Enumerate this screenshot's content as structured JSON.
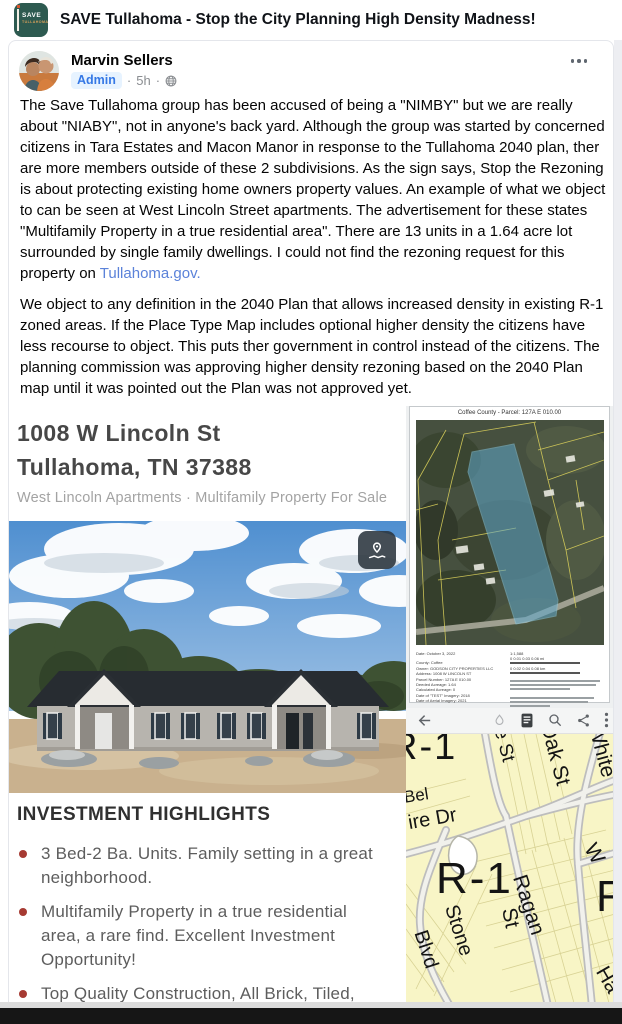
{
  "group_header": {
    "title": "SAVE Tullahoma - Stop the City Planning High Density Madness!",
    "logo_line1": "SAVE",
    "logo_line2": "TULLAHOMA"
  },
  "post": {
    "author": "Marvin Sellers",
    "badge": "Admin",
    "dot1": "·",
    "timestamp": "5h",
    "dot2": "·",
    "body": [
      {
        "text": "The Save Tullahoma group has been accused of being a \"NIMBY\" but we are really about \"NIABY\", not in anyone's back yard. Although the group was started by concerned citizens in Tara Estates and Macon Manor in response to the Tullahoma 2040 plan, ther are more members outside of these 2 subdivisions. As the sign says, Stop the Rezoning is about protecting existing home owners property values. An example of what we object to can be seen at West Lincoln Street apartments. The advertisement for these states \"Multifamily Property in a true residential area\". There are 13 units in a 1.64 acre lot surrounded by single family dwellings. I could not find the rezoning request for this property on ",
        "link": "Tullahoma.gov."
      },
      {
        "text": "We object to any definition in the 2040 Plan that allows increased density in existing R-1 zoned areas. If the Place Type Map includes optional higher density the citizens have less recourse to object. This puts ther government in control instead of the citizens. The planning commission was approving higher density rezoning based on the 2040 Plan map until it was pointed out the Plan was not approved yet."
      },
      {
        "text": "We have no objection to growth but it should not come at the expense of current residents, be it decreased property value or increased taxes. Citizens of Tullahoma need to speak up to keep the power in the people's hands rather than the government."
      }
    ]
  },
  "listing": {
    "address_line1": "1008 W Lincoln St",
    "address_line2": "Tullahoma, TN 37388",
    "subtitle": "West Lincoln Apartments · Multifamily Property For Sale",
    "highlights_title": "INVESTMENT HIGHLIGHTS",
    "highlights": [
      "3 Bed-2 Ba. Units. Family setting in a great neighborhood.",
      "Multifamily Property in a true residential area, a rare find. Excellent Investment Opportunity!",
      "Top Quality Construction, All Brick, Tiled, Granite Countertops. Throughout each unit"
    ]
  },
  "parcel_doc": {
    "title": "Coffee County - Parcel: 127A E 010.00",
    "footer_lines": [
      "Date: October 3, 2022",
      "County: Coffee",
      "Owner: GODSON CITY PROPERTIES LLC",
      "Address: 1008 W LINCOLN ST",
      "Parcel Number: 127A E 010.00",
      "Deeded Acreage: 1.64",
      "Calculated Acreage: 0",
      "Date of \"TEST\" Imagery: 2018",
      "Date of Aerial Imagery: 2021"
    ],
    "scale_ratio": "1:1,588",
    "scale_mi": "0   0.01   0.03   0.06 mi",
    "scale_km": "0   0.02   0.04   0.08 km"
  },
  "zoning_map": {
    "labels": [
      {
        "text": "R-1"
      },
      {
        "text": "Bel"
      },
      {
        "text": "ire Dr"
      },
      {
        "text": "R-1"
      },
      {
        "text": "Stone"
      },
      {
        "text": "Blvd"
      },
      {
        "text": "St"
      },
      {
        "text": "Ragan"
      },
      {
        "text": "R"
      },
      {
        "text": "e St"
      },
      {
        "text": "Oak St"
      },
      {
        "text": "White"
      },
      {
        "text": "W"
      },
      {
        "text": "Ha"
      }
    ]
  },
  "colors": {
    "admin_blue": "#3578e5",
    "link_blue": "#5b82d9",
    "bullet_red": "#a63a32",
    "zone_yellow": "#f8f5c6",
    "logo_teal": "#2d5a50",
    "parcel_highlight": "#5fa8cc"
  }
}
